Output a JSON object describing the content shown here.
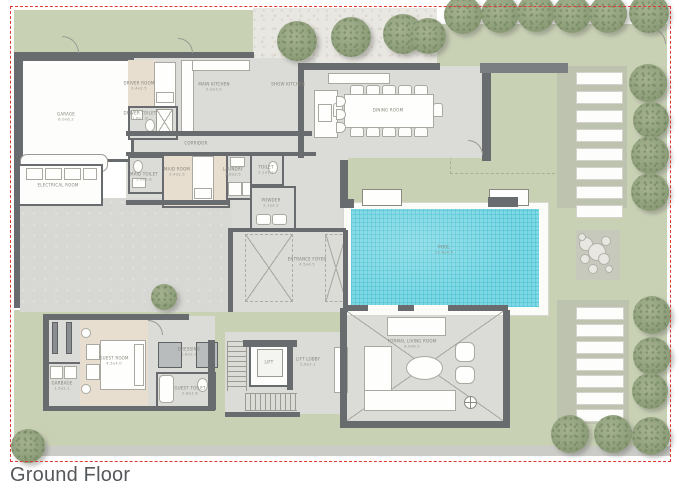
{
  "title": "Ground Floor",
  "colors": {
    "boundary": "#dc3a30",
    "lawn": "#c9d1b5",
    "gravel": "#e9e7e1",
    "stepping_panel": "#bdc3af",
    "floor": "#dbdbd7",
    "bedroom_beige": "#e8decf",
    "wall": "#696c6e",
    "pool_water": "#7fd8e4",
    "pool_deck": "#fbfbf8",
    "tree": "#93a37f",
    "label_text": "#85857c",
    "title_text": "#55585b"
  },
  "rooms": [
    {
      "id": "garage",
      "name": "GARAGE",
      "dim": "6.0x6.2",
      "x": 66,
      "y": 117
    },
    {
      "id": "driver-room",
      "name": "DRIVER ROOM",
      "dim": "3.4x2.5",
      "x": 139,
      "y": 86
    },
    {
      "id": "driver-toilet",
      "name": "DRIVER TOILET",
      "dim": "1.6x1.8",
      "x": 140,
      "y": 116
    },
    {
      "id": "main-kitchen",
      "name": "MAIN KITCHEN",
      "dim": "5.0x3.5",
      "x": 214,
      "y": 87
    },
    {
      "id": "corridor",
      "name": "CORRIDOR",
      "dim": "",
      "x": 196,
      "y": 143
    },
    {
      "id": "electrical-room",
      "name": "ELECTRICAL ROOM",
      "dim": "",
      "x": 58,
      "y": 185
    },
    {
      "id": "maid-toilet",
      "name": "MAID TOILET",
      "dim": "1.6x1.8",
      "x": 144,
      "y": 177
    },
    {
      "id": "maid-room",
      "name": "MAID ROOM",
      "dim": "3.4x2.5",
      "x": 177,
      "y": 172
    },
    {
      "id": "laundry",
      "name": "LAUNDRY",
      "dim": "2.6x2.5",
      "x": 233,
      "y": 172
    },
    {
      "id": "toilet",
      "name": "TOILET",
      "dim": "2.1x1.2",
      "x": 266,
      "y": 170
    },
    {
      "id": "powder",
      "name": "POWDER",
      "dim": "2.1x2.2",
      "x": 271,
      "y": 203
    },
    {
      "id": "entrance-foyer",
      "name": "ENTRANCE FOYER",
      "dim": "4.5x4.5",
      "x": 307,
      "y": 262
    },
    {
      "id": "show-kitchen",
      "name": "SHOW KITCHEN",
      "dim": "",
      "x": 288,
      "y": 84
    },
    {
      "id": "dining-room",
      "name": "DINING ROOM",
      "dim": "",
      "x": 388,
      "y": 110
    },
    {
      "id": "pool",
      "name": "POOL",
      "dim": "11.6x4.5",
      "x": 444,
      "y": 250
    },
    {
      "id": "garbage",
      "name": "GARBAGE",
      "dim": "1.5x2.1",
      "x": 62,
      "y": 386
    },
    {
      "id": "guest-room",
      "name": "GUEST ROOM",
      "dim": "4.5x4.0",
      "x": 114,
      "y": 361
    },
    {
      "id": "dressing",
      "name": "DRESSING",
      "dim": "1.6x2.1",
      "x": 189,
      "y": 352
    },
    {
      "id": "guest-toilet",
      "name": "GUEST TOILET",
      "dim": "2.6x1.6",
      "x": 190,
      "y": 391
    },
    {
      "id": "lift",
      "name": "LIFT",
      "dim": "",
      "x": 269,
      "y": 362
    },
    {
      "id": "lift-lobby",
      "name": "LIFT LOBBY",
      "dim": "2.6x2.1",
      "x": 308,
      "y": 362
    },
    {
      "id": "formal-living",
      "name": "FORMAL LIVING ROOM",
      "dim": "8.0x6.5",
      "x": 412,
      "y": 344
    }
  ],
  "landscape": {
    "trees": [
      {
        "cx": 297,
        "cy": 41,
        "r": 20
      },
      {
        "cx": 351,
        "cy": 37,
        "r": 20
      },
      {
        "cx": 403,
        "cy": 34,
        "r": 20
      },
      {
        "cx": 428,
        "cy": 36,
        "r": 18
      },
      {
        "cx": 463,
        "cy": 15,
        "r": 19
      },
      {
        "cx": 500,
        "cy": 14,
        "r": 19
      },
      {
        "cx": 536,
        "cy": 13,
        "r": 19
      },
      {
        "cx": 572,
        "cy": 14,
        "r": 19
      },
      {
        "cx": 608,
        "cy": 14,
        "r": 19
      },
      {
        "cx": 649,
        "cy": 13,
        "r": 20
      },
      {
        "cx": 648,
        "cy": 83,
        "r": 19
      },
      {
        "cx": 651,
        "cy": 120,
        "r": 18
      },
      {
        "cx": 650,
        "cy": 155,
        "r": 19
      },
      {
        "cx": 650,
        "cy": 192,
        "r": 19
      },
      {
        "cx": 652,
        "cy": 315,
        "r": 19
      },
      {
        "cx": 652,
        "cy": 356,
        "r": 19
      },
      {
        "cx": 650,
        "cy": 391,
        "r": 18
      },
      {
        "cx": 570,
        "cy": 434,
        "r": 19
      },
      {
        "cx": 613,
        "cy": 434,
        "r": 19
      },
      {
        "cx": 651,
        "cy": 436,
        "r": 19
      },
      {
        "cx": 28,
        "cy": 446,
        "r": 17
      },
      {
        "cx": 164,
        "cy": 297,
        "r": 13
      }
    ],
    "stepping_stones": [
      {
        "x": 576,
        "y": 72,
        "w": 45,
        "h": 11,
        "count": 8,
        "gap": 19
      },
      {
        "x": 576,
        "y": 307,
        "w": 46,
        "h": 11,
        "count": 7,
        "gap": 17
      }
    ],
    "boulders": [
      {
        "cx": 585,
        "cy": 243,
        "r": 6
      },
      {
        "cx": 596,
        "cy": 251,
        "r": 8
      },
      {
        "cx": 584,
        "cy": 258,
        "r": 4
      },
      {
        "cx": 605,
        "cy": 240,
        "r": 4
      },
      {
        "cx": 603,
        "cy": 258,
        "r": 5
      },
      {
        "cx": 592,
        "cy": 268,
        "r": 4
      },
      {
        "cx": 581,
        "cy": 236,
        "r": 3
      },
      {
        "cx": 608,
        "cy": 268,
        "r": 3
      }
    ]
  },
  "furniture": {
    "dining_chairs": [
      {
        "x": 350,
        "y": 85,
        "w": 12,
        "h": 8
      },
      {
        "x": 366,
        "y": 85,
        "w": 12,
        "h": 8
      },
      {
        "x": 382,
        "y": 85,
        "w": 12,
        "h": 8
      },
      {
        "x": 398,
        "y": 85,
        "w": 12,
        "h": 8
      },
      {
        "x": 414,
        "y": 85,
        "w": 12,
        "h": 8
      },
      {
        "x": 350,
        "y": 127,
        "w": 12,
        "h": 8
      },
      {
        "x": 366,
        "y": 127,
        "w": 12,
        "h": 8
      },
      {
        "x": 382,
        "y": 127,
        "w": 12,
        "h": 8
      },
      {
        "x": 398,
        "y": 127,
        "w": 12,
        "h": 8
      },
      {
        "x": 414,
        "y": 127,
        "w": 12,
        "h": 8
      },
      {
        "x": 333,
        "y": 103,
        "w": 8,
        "h": 12
      },
      {
        "x": 433,
        "y": 103,
        "w": 8,
        "h": 12
      }
    ],
    "kitchen_stools": [
      {
        "x": 336,
        "y": 96,
        "w": 8,
        "h": 9
      },
      {
        "x": 336,
        "y": 109,
        "w": 8,
        "h": 9
      },
      {
        "x": 336,
        "y": 122,
        "w": 8,
        "h": 9
      }
    ]
  }
}
